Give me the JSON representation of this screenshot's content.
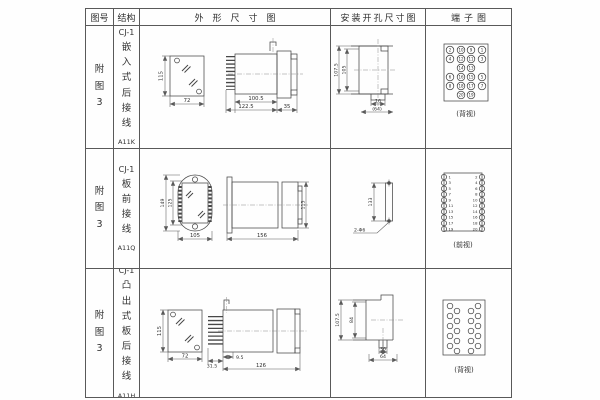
{
  "header": {
    "figure": "图号",
    "structure": "结构",
    "outline": "外形尺寸图",
    "install": "安装开孔尺寸图",
    "terminal": "端子图"
  },
  "rows": [
    {
      "figure": "附图3",
      "structure": {
        "model": "CJ-1",
        "desc": "嵌入式后接线",
        "code": "A11K"
      },
      "outline": {
        "front_height": "115",
        "front_width": "72",
        "body_length": "100.5",
        "total_length": "122.5",
        "flange_depth": "35"
      },
      "install": {
        "outer_height": "107.5",
        "inner_height": "105",
        "slot_width": "16",
        "cutout_width": "(64)"
      },
      "terminal": {
        "view_label": "(背视)",
        "numbers": [
          "2",
          "10",
          "9",
          "1",
          "4",
          "12",
          "11",
          "3",
          "14",
          "13",
          "6",
          "16",
          "15",
          "5",
          "8",
          "18",
          "17",
          "7",
          "20",
          "19"
        ]
      }
    },
    {
      "figure": "附图3",
      "structure": {
        "model": "CJ-1",
        "desc": "板前接线",
        "code": "A11Q"
      },
      "outline": {
        "outer_height": "149",
        "inner_height": "125",
        "front_width": "105",
        "total_length": "156",
        "body_height": "115"
      },
      "install": {
        "hole_pitch": "133",
        "hole_note": "2-Φ6"
      },
      "terminal": {
        "view_label": "(前视)",
        "left_numbers": [
          "1",
          "3",
          "5",
          "7",
          "9",
          "11",
          "13",
          "15",
          "17",
          "19"
        ],
        "right_numbers": [
          "2",
          "4",
          "6",
          "8",
          "10",
          "12",
          "14",
          "16",
          "18",
          "20"
        ]
      }
    },
    {
      "figure": "附图3",
      "structure": {
        "model": "CJ-1",
        "desc": "凸出式板后接线",
        "code": "A11H"
      },
      "outline": {
        "front_height": "115",
        "front_width": "72",
        "pin_length": "31.5",
        "offset": "9.5",
        "body_length": "126"
      },
      "install": {
        "outer_height": "107.5",
        "inner_height": "84",
        "slot_width": "36",
        "cutout_width": "64"
      },
      "terminal": {
        "view_label": "(背视)"
      }
    }
  ]
}
